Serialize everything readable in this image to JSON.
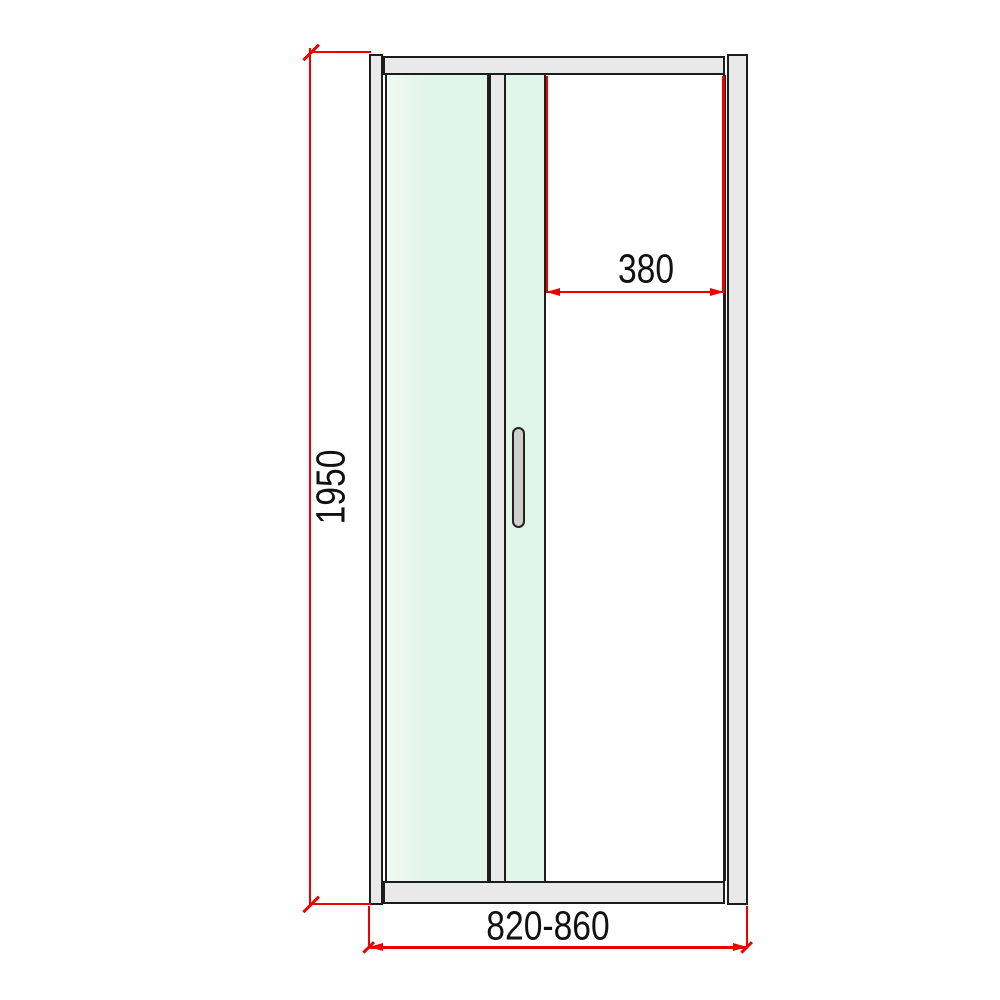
{
  "labels": {
    "height_mm": "1950",
    "opening_width_mm": "380",
    "width_range_mm": "820-860"
  },
  "colors": {
    "dimension_red": "#ee0000",
    "frame_fill": "#e9e9e9",
    "frame_outline": "#1d1d1d",
    "glass_tint": "#e2f5ea",
    "glass_tint_light": "#eefaf3",
    "handle_fill": "#cfcfcf",
    "background": "#ffffff",
    "label_color": "#111111"
  },
  "parts": [
    "wall-profile-left",
    "top-rail",
    "fixed-glass-panel",
    "center-stile",
    "folding-glass-panel",
    "door-handle",
    "door-opening",
    "wall-profile-right",
    "bottom-rail"
  ]
}
